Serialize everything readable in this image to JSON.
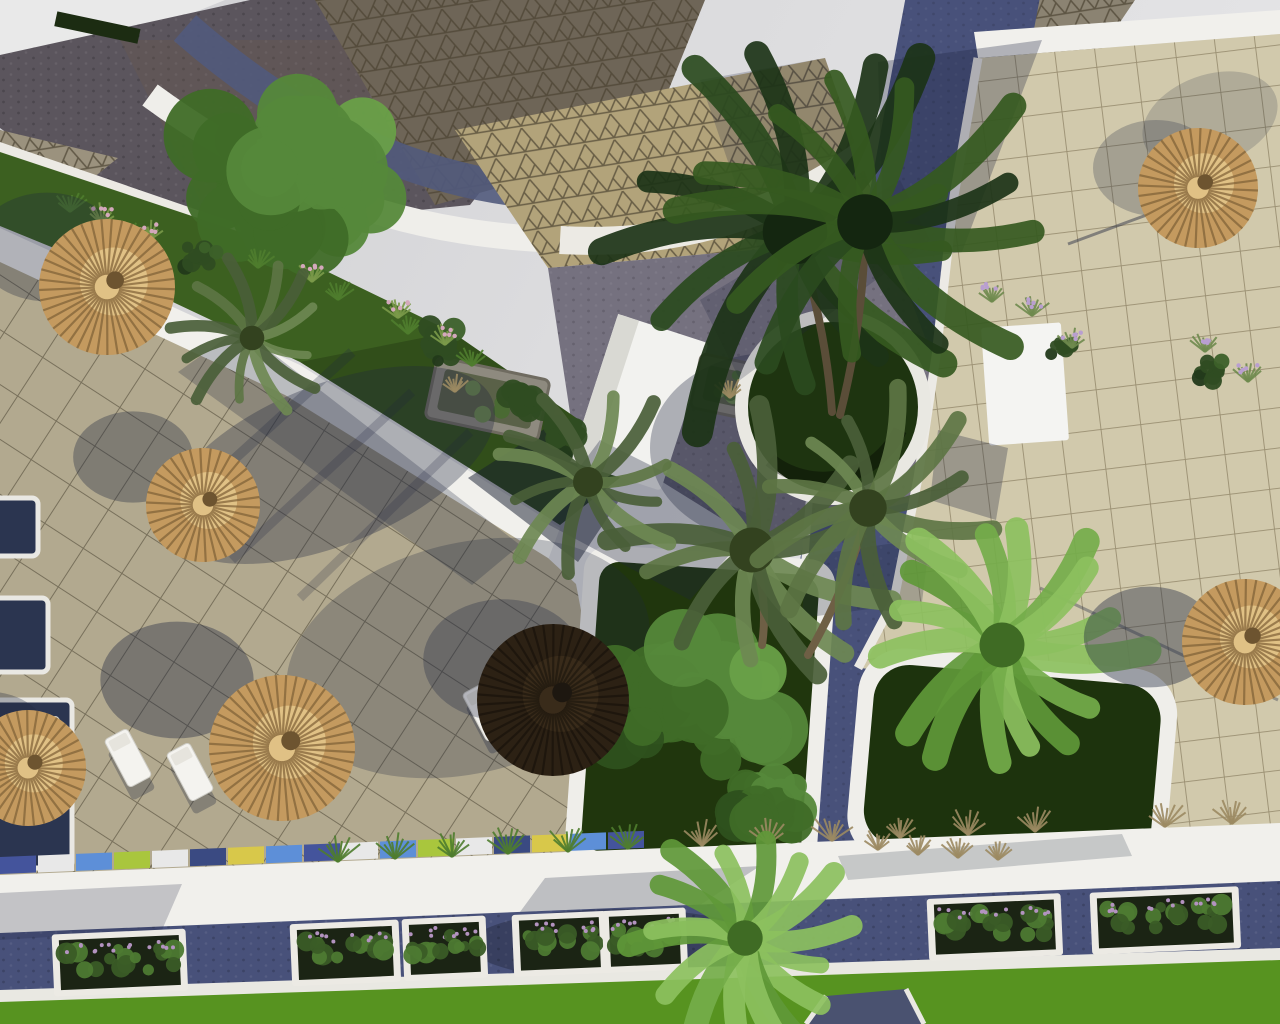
{
  "meta": {
    "title": "Aerial 3D architectural rendering — resort plaza with palms, straw parasols, tiled terraces, cobblestone paths, planters and lawns",
    "view": "top-down aerial",
    "time_of_day": "sunny, long shadows cast toward lower-left"
  },
  "palette": {
    "backdrop": "#d9d9db",
    "white": "#f1f0ec",
    "navy": "#48517a",
    "navyDark": "#3c4466",
    "cobTopLeft": "#5b555d",
    "grayApron": "#75717f",
    "plazaLeft": "#b2a98f",
    "plazaRight": "#d1c9ac",
    "triBright": "#b2a37a",
    "triShadow": "#6e6557",
    "triSmall": "#9b927e",
    "greenStrip": "#3c6020",
    "lawn": "#579320",
    "planterSoil": "#20360d",
    "stone": "#8e8a7f",
    "strawBase": "#c49a5f",
    "strawCap": "#e2c387",
    "strawLine": "#7e6036",
    "darkUmbrella": "#2c2114",
    "trunk": "#6e5f45",
    "shadow": "rgba(30,38,62,0.34)"
  },
  "scene": {
    "umbrellas": [
      {
        "x": 107,
        "y": 287,
        "r": 68,
        "style": "straw",
        "sdx": -60,
        "sdy": -40,
        "sa": 0.3
      },
      {
        "x": 203,
        "y": 505,
        "r": 57,
        "style": "straw",
        "sdx": -70,
        "sdy": -48,
        "sa": 0.34
      },
      {
        "x": 282,
        "y": 748,
        "r": 73,
        "style": "straw",
        "sdx": -105,
        "sdy": -68,
        "sa": 0.38
      },
      {
        "x": 28,
        "y": 768,
        "r": 58,
        "style": "straw",
        "sdx": -40,
        "sdy": -30,
        "sa": 0.3
      },
      {
        "x": 553,
        "y": 700,
        "r": 76,
        "style": "dark",
        "sdx": -50,
        "sdy": -40,
        "sa": 0.3
      },
      {
        "x": 1198,
        "y": 188,
        "r": 60,
        "style": "straw",
        "sdx": -42,
        "sdy": -20,
        "sa": 0.25
      },
      {
        "x": 1245,
        "y": 642,
        "r": 63,
        "style": "straw",
        "sdx": -95,
        "sdy": -5,
        "sa": 0.4
      }
    ],
    "loungers": [
      {
        "x": 128,
        "y": 758,
        "rot": -28
      },
      {
        "x": 190,
        "y": 772,
        "rot": -28
      },
      {
        "x": 486,
        "y": 712,
        "rot": -28
      },
      {
        "x": 58,
        "y": 745,
        "rot": -28
      }
    ],
    "planter_boxes": [
      {
        "x": 60,
        "w": 120
      },
      {
        "x": 298,
        "w": 95
      },
      {
        "x": 410,
        "w": 70
      },
      {
        "x": 520,
        "w": 80
      },
      {
        "x": 610,
        "w": 70
      },
      {
        "x": 935,
        "w": 120
      },
      {
        "x": 1098,
        "w": 135
      }
    ],
    "curb_colors": [
      "#44549c",
      "#e8e8e8",
      "#5d8fd8",
      "#a9c63d",
      "#e8e8e8",
      "#3a4a82",
      "#d8c84a",
      "#5d8fd8"
    ],
    "palms": [
      {
        "x": 795,
        "y": 232,
        "r": 215,
        "type": "dark",
        "trunk": [
          832,
          412
        ]
      },
      {
        "x": 865,
        "y": 222,
        "r": 185,
        "type": "dark",
        "trunk": [
          840,
          415
        ]
      },
      {
        "x": 752,
        "y": 550,
        "r": 150,
        "type": "olive",
        "trunk": [
          762,
          645
        ]
      },
      {
        "x": 868,
        "y": 508,
        "r": 125,
        "type": "olive",
        "trunk": [
          808,
          655
        ]
      },
      {
        "x": 588,
        "y": 482,
        "r": 100,
        "type": "olive"
      },
      {
        "x": 252,
        "y": 338,
        "r": 82,
        "type": "olive"
      },
      {
        "x": 1002,
        "y": 645,
        "r": 150,
        "type": "fan"
      },
      {
        "x": 745,
        "y": 938,
        "r": 118,
        "type": "fan"
      }
    ],
    "bushes": [
      {
        "x": 282,
        "y": 182,
        "r": 132,
        "tone": "lush"
      },
      {
        "x": 688,
        "y": 700,
        "r": 118,
        "tone": "lush"
      },
      {
        "x": 772,
        "y": 800,
        "r": 62,
        "tone": "lush"
      },
      {
        "x": 520,
        "y": 402,
        "r": 40,
        "tone": "dark"
      },
      {
        "x": 565,
        "y": 438,
        "r": 36,
        "tone": "dark"
      },
      {
        "x": 198,
        "y": 258,
        "r": 30,
        "tone": "dark"
      },
      {
        "x": 438,
        "y": 340,
        "r": 34,
        "tone": "dark"
      },
      {
        "x": 1210,
        "y": 372,
        "r": 26,
        "tone": "dark"
      },
      {
        "x": 1065,
        "y": 345,
        "r": 24,
        "tone": "dark"
      }
    ],
    "tufts": [
      {
        "x": 70,
        "y": 212,
        "t": "green"
      },
      {
        "x": 128,
        "y": 240,
        "t": "green"
      },
      {
        "x": 258,
        "y": 268,
        "t": "green"
      },
      {
        "x": 338,
        "y": 300,
        "t": "green"
      },
      {
        "x": 408,
        "y": 334,
        "t": "green"
      },
      {
        "x": 472,
        "y": 366,
        "t": "green"
      },
      {
        "x": 150,
        "y": 240,
        "t": "pink"
      },
      {
        "x": 312,
        "y": 282,
        "t": "pink"
      },
      {
        "x": 398,
        "y": 318,
        "t": "pink"
      },
      {
        "x": 102,
        "y": 224,
        "t": "pink"
      },
      {
        "x": 445,
        "y": 345,
        "t": "pink"
      },
      {
        "x": 1032,
        "y": 316,
        "t": "purple"
      },
      {
        "x": 1072,
        "y": 348,
        "t": "purple"
      },
      {
        "x": 1205,
        "y": 352,
        "t": "purple"
      },
      {
        "x": 1248,
        "y": 382,
        "t": "purple"
      },
      {
        "x": 992,
        "y": 302,
        "t": "purple"
      },
      {
        "x": 338,
        "y": 862,
        "t": "green",
        "s": 1.3
      },
      {
        "x": 395,
        "y": 859,
        "t": "green",
        "s": 1.3
      },
      {
        "x": 452,
        "y": 857,
        "t": "green",
        "s": 1.3
      },
      {
        "x": 508,
        "y": 854,
        "t": "green",
        "s": 1.3
      },
      {
        "x": 568,
        "y": 852,
        "t": "green",
        "s": 1.3
      },
      {
        "x": 628,
        "y": 849,
        "t": "green",
        "s": 1.3
      },
      {
        "x": 702,
        "y": 846,
        "t": "dry",
        "s": 1.3
      },
      {
        "x": 768,
        "y": 844,
        "t": "dry",
        "s": 1.2
      },
      {
        "x": 832,
        "y": 841,
        "t": "dry",
        "s": 1.3
      },
      {
        "x": 900,
        "y": 838,
        "t": "dry",
        "s": 1.2
      },
      {
        "x": 968,
        "y": 835,
        "t": "dry",
        "s": 1.3
      },
      {
        "x": 1035,
        "y": 832,
        "t": "dry",
        "s": 1.2
      },
      {
        "x": 1165,
        "y": 827,
        "t": "dry",
        "s": 1.3
      },
      {
        "x": 1232,
        "y": 824,
        "t": "dry",
        "s": 1.2
      },
      {
        "x": 878,
        "y": 850,
        "t": "dry"
      },
      {
        "x": 918,
        "y": 855,
        "t": "dry"
      },
      {
        "x": 958,
        "y": 858,
        "t": "dry"
      },
      {
        "x": 998,
        "y": 860,
        "t": "dry"
      },
      {
        "x": 455,
        "y": 392,
        "t": "dry"
      },
      {
        "x": 730,
        "y": 398,
        "t": "dry"
      }
    ],
    "side_pads": [
      {
        "x": -14,
        "y": 498,
        "w": 52,
        "h": 58
      },
      {
        "x": -16,
        "y": 598,
        "w": 64,
        "h": 74
      },
      {
        "x": -20,
        "y": 700,
        "w": 92,
        "h": 168
      }
    ],
    "stone_planters": [
      {
        "x": 430,
        "y": 368,
        "w": 115,
        "h": 62,
        "rot": 12
      },
      {
        "x": 695,
        "y": 360,
        "w": 70,
        "h": 55,
        "rot": 12
      }
    ]
  }
}
